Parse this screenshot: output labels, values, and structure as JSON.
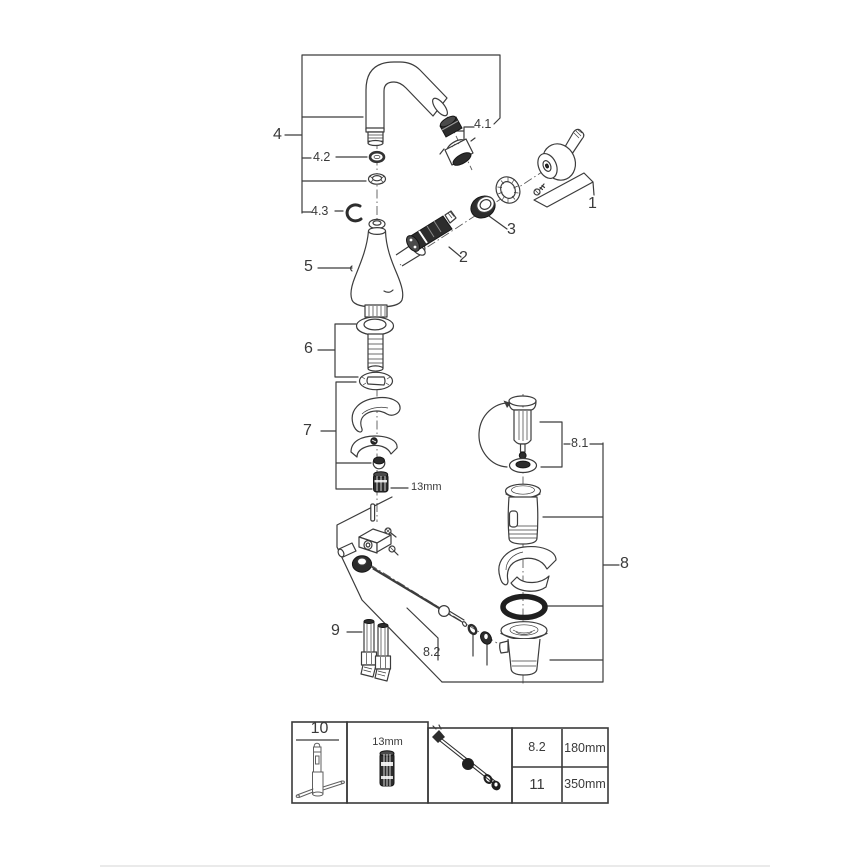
{
  "colors": {
    "background": "#ffffff",
    "ink": "#3c3c3c",
    "dark_fill": "#2d2d2d",
    "footer_divider": "#d4d4d4"
  },
  "callouts": {
    "c1": "1",
    "c2": "2",
    "c3": "3",
    "c4": "4",
    "c4_1": "4.1",
    "c4_2": "4.2",
    "c4_3": "4.3",
    "c5": "5",
    "c6": "6",
    "c7": "7",
    "c8": "8",
    "c8_1": "8.1",
    "c8_2": "8.2",
    "c9": "9",
    "wrench_size": "13mm"
  },
  "legend": {
    "tool_label": "10",
    "socket_label": "13mm",
    "rows": [
      {
        "ref": "8.2",
        "length": "180mm"
      },
      {
        "ref": "11",
        "length": "350mm"
      }
    ]
  }
}
